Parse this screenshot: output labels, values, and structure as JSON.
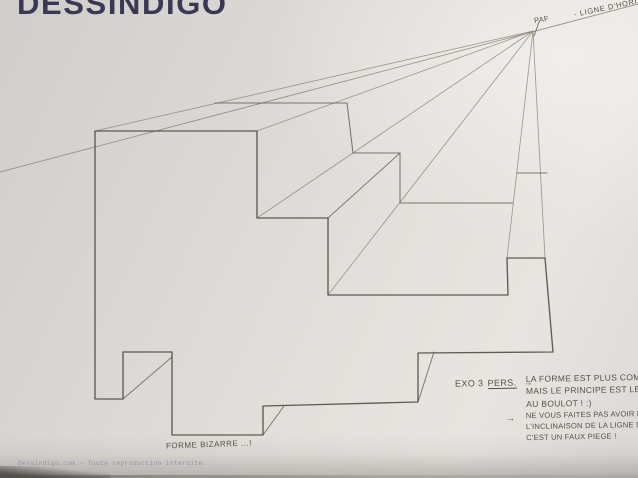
{
  "logo": {
    "text": "DESSINDIGO",
    "color": "#3b3853"
  },
  "labels": {
    "vanishing_point": "PAF",
    "horizon": "- LIGNE D'HORIZON",
    "shape": "FORME BIZARRE ...!",
    "exo_number": "EXO 3",
    "exo_topic": "PERS.",
    "arrow": "→",
    "note_a_line1": "LA FORME EST PLUS COM",
    "note_a_line2": "MAIS LE PRINCIPE EST LE",
    "note_a_line3": "AU BOULOT ! :)",
    "note_b_line1": "NE VOUS FAITES PAS AVOIR PA",
    "note_b_line2": "L'INCLINAISON DE LA LIGNE D'HO",
    "note_b_line3": "C'EST UN FAUX PIEGE !"
  },
  "footer": {
    "text": "Dessindigo.com - Toute reproduction interdite."
  },
  "colors": {
    "paper": "#e2dfdb",
    "pencil_front": "#5a5249",
    "pencil_back": "#6e675e",
    "pencil_ray": "#8e8478",
    "ink": "#574f44"
  },
  "drawing": {
    "viewbox": [
      0,
      0,
      638,
      478
    ],
    "vanishing_point": [
      533,
      31
    ],
    "vp_tick": [
      [
        539,
        22
      ],
      [
        534,
        36
      ]
    ],
    "horizon_line": [
      [
        0,
        172
      ],
      [
        638,
        4
      ]
    ],
    "front_face": [
      [
        95,
        131
      ],
      [
        257,
        131
      ],
      [
        257,
        218
      ],
      [
        328,
        218
      ],
      [
        328,
        295
      ],
      [
        508,
        295
      ],
      [
        507,
        258
      ],
      [
        545,
        258
      ],
      [
        553,
        352
      ],
      [
        418,
        353
      ],
      [
        418,
        402
      ],
      [
        263,
        406
      ],
      [
        263,
        435
      ],
      [
        172,
        435
      ],
      [
        172,
        352
      ],
      [
        123,
        352
      ],
      [
        123,
        399
      ],
      [
        95,
        399
      ]
    ],
    "back_edges": [
      [
        [
          215,
          103
        ],
        [
          347,
          103
        ],
        [
          353,
          153
        ],
        [
          400,
          153
        ],
        [
          400,
          203
        ],
        [
          513,
          203
        ]
      ],
      [
        [
          517,
          173
        ],
        [
          547,
          173
        ]
      ]
    ],
    "rays_from_vp": [
      [
        95,
        131
      ],
      [
        257,
        131
      ],
      [
        257,
        218
      ],
      [
        328,
        295
      ],
      [
        507,
        258
      ],
      [
        545,
        258
      ]
    ],
    "receding_stubs": [
      [
        [
          328,
          218
        ],
        [
          400,
          153
        ]
      ],
      [
        [
          418,
          402
        ],
        [
          434,
          352
        ]
      ],
      [
        [
          263,
          435
        ],
        [
          284,
          406
        ]
      ],
      [
        [
          123,
          399
        ],
        [
          172,
          357
        ]
      ]
    ]
  }
}
